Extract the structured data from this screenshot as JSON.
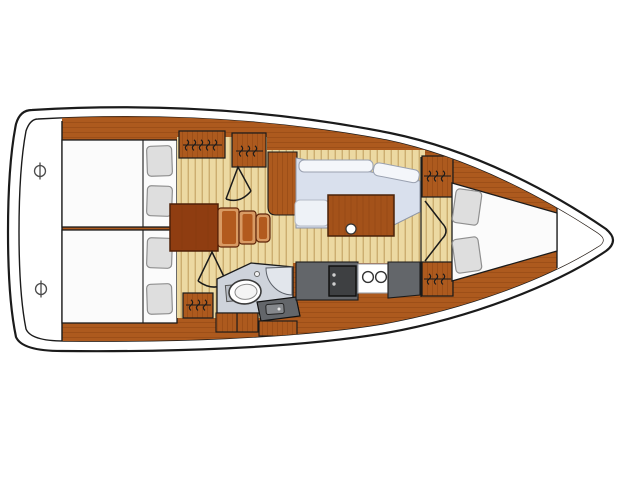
{
  "diagram": {
    "type": "sailboat-interior-floor-plan",
    "orientation": "bow-right-stern-left",
    "areas": [
      "transom-swim-platform",
      "aft-cabin-port",
      "aft-cabin-starboard",
      "companionway-steps",
      "salon-settee",
      "salon-table",
      "galley",
      "head-bathroom",
      "forward-v-berth-cabin",
      "bow-deck"
    ],
    "symbols": [
      "deck-fitting-icon",
      "hanging-locker-icon",
      "door-swing-icon",
      "double-door-icon",
      "toilet-icon",
      "corner-shower-icon",
      "double-sink-icon",
      "stove-icon",
      "berth-pillow-icon"
    ]
  },
  "colors": {
    "line": "#1b1b1b",
    "hull_fill": "#ffffff",
    "wood": "#ad5a1e",
    "wood_grain": "#7e3a0d",
    "floor": "#ecd9a2",
    "floor_stripe": "#c8a96b",
    "berth": "#fbfbfb",
    "pillow": "#dedede",
    "pillow_edge": "#8f8f8f",
    "settee": "#d9e0ed",
    "settee_back": "#f4f6fa",
    "seat_white": "#eef2f7",
    "head_floor": "#ced3db",
    "shower": "#e2e6ec",
    "counter": "#63666a",
    "stove": "#3e4042",
    "table": "#a4521a",
    "step_dark": "#8f3d11",
    "step": "#b25a1e",
    "step_edge": "#d89a63"
  }
}
